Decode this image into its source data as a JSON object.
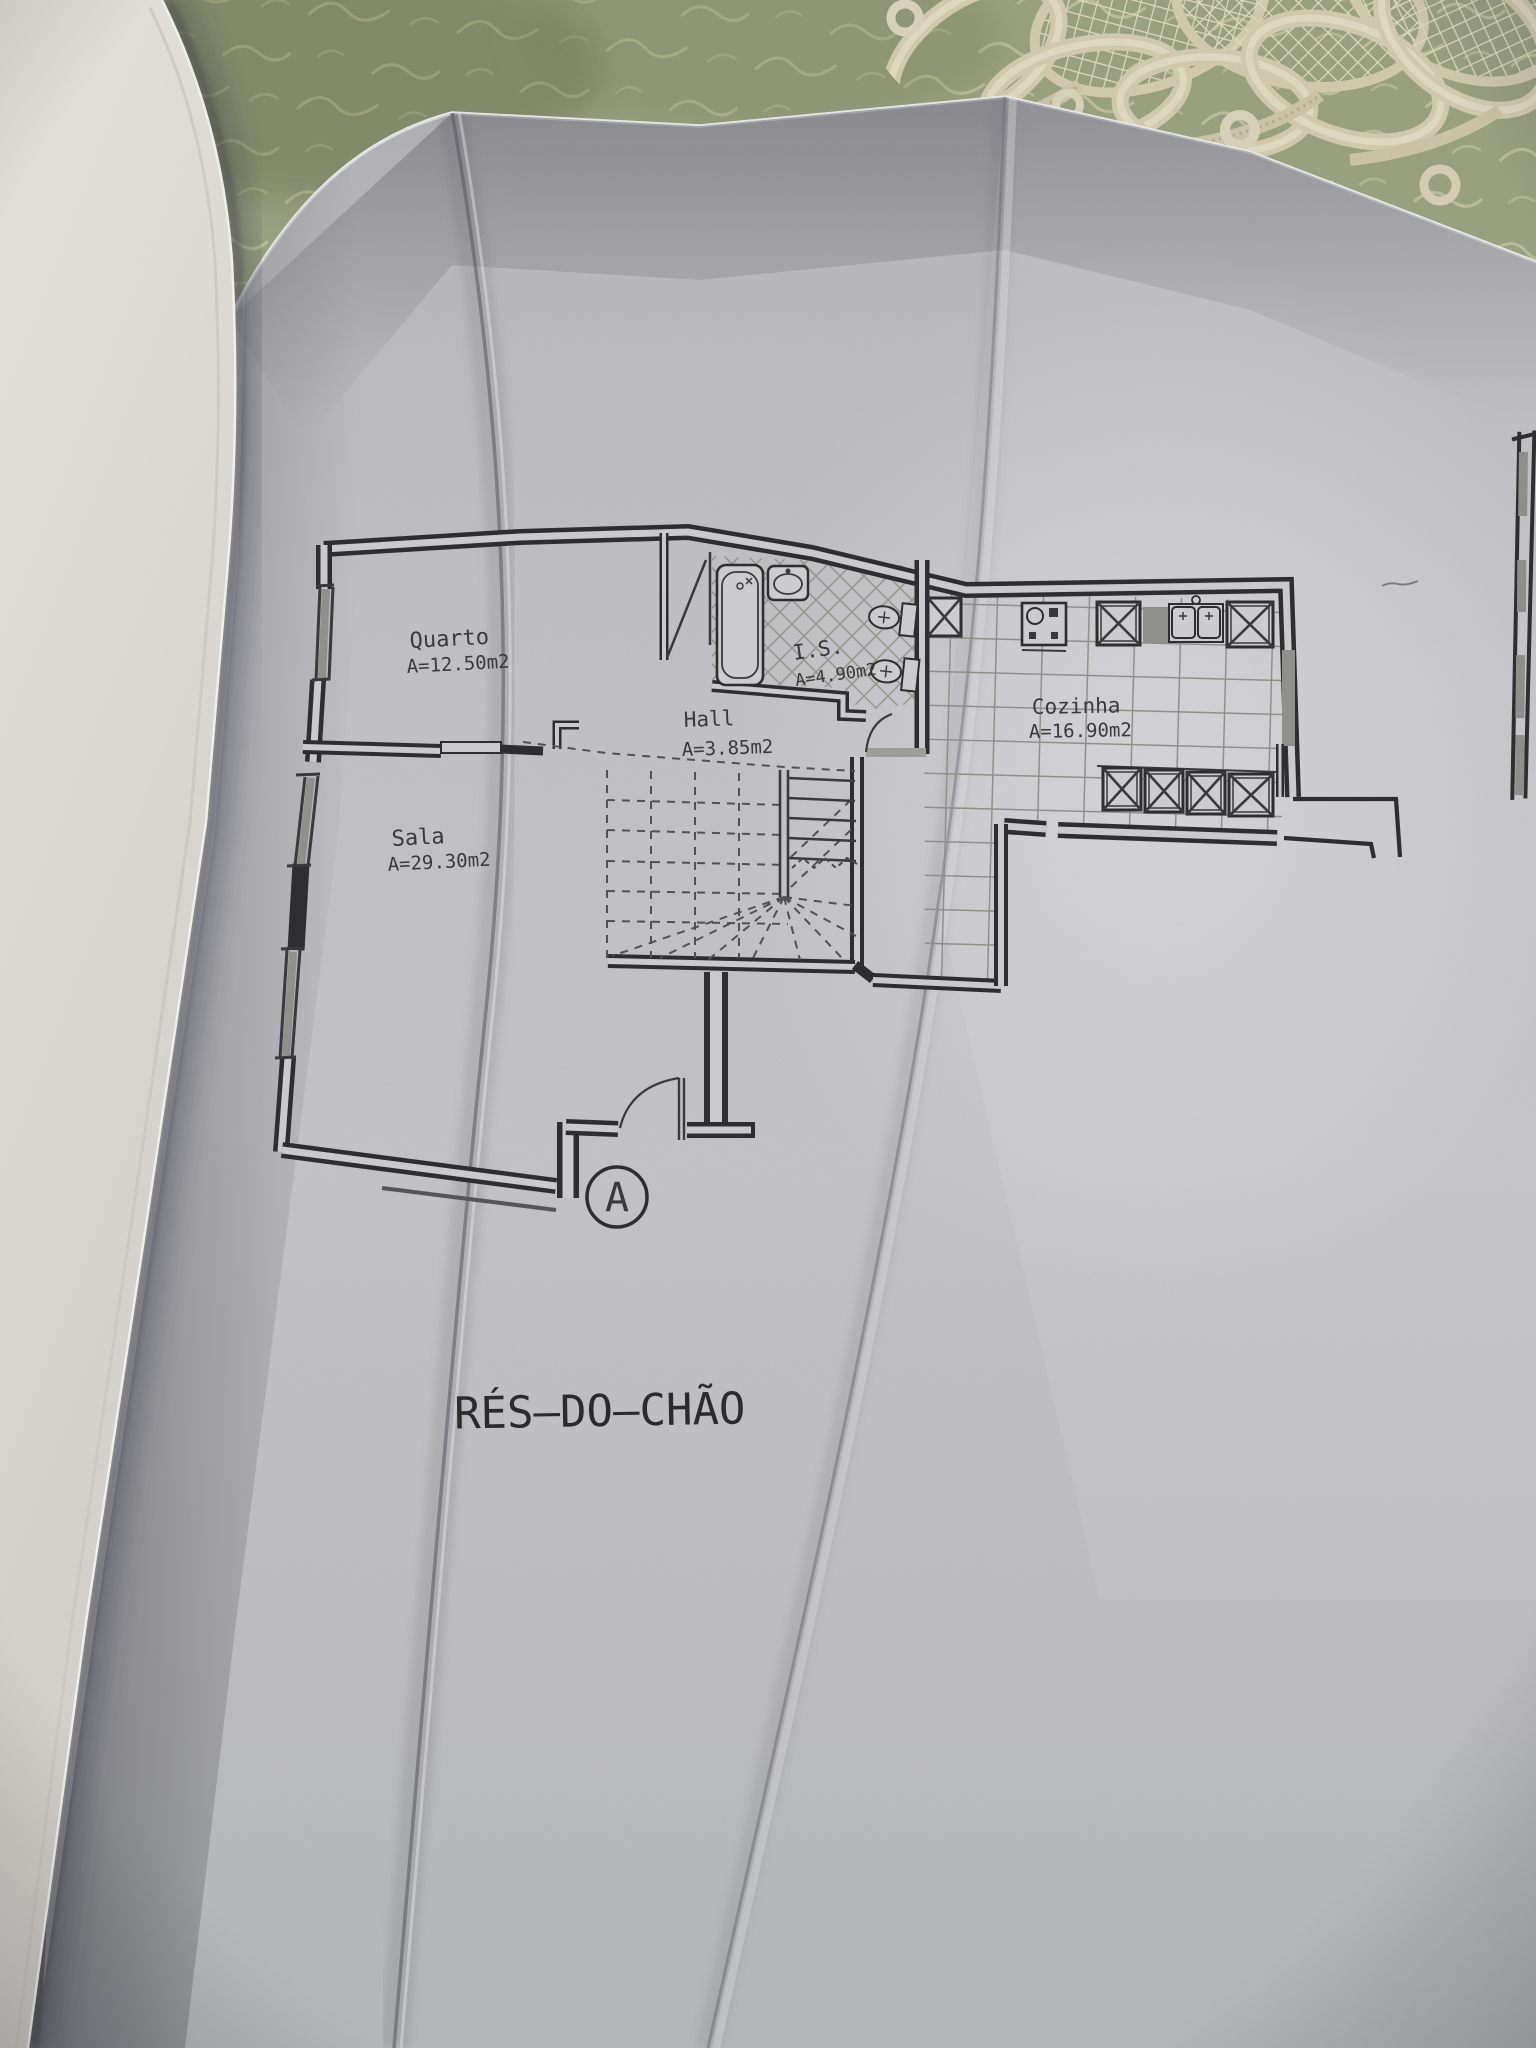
{
  "scene": {
    "description": "Photograph of a ground-floor architectural plan on a folded sheet in an open binder, on a lace-edged tablecloth",
    "colors": {
      "tablecloth": "#99a080",
      "lace": "#d6cfb5",
      "page_paper": "#c8c8cc",
      "binder_cover": "#e0ddd8",
      "ink": "#2d2d2f",
      "pencil_grid": "#8e8e8a",
      "window_fill": "#8f8f8b"
    }
  },
  "floor_plan": {
    "title": "RÉS—DO—CHÃO",
    "section_marker": "A",
    "rooms": [
      {
        "id": "quarto",
        "name": "Quarto",
        "area": "A=12.50m2"
      },
      {
        "id": "sala",
        "name": "Sala",
        "area": "A=29.30m2"
      },
      {
        "id": "hall",
        "name": "Hall",
        "area": "A=3.85m2"
      },
      {
        "id": "is",
        "name": "I.S.",
        "area": "A=4.90m2"
      },
      {
        "id": "cozinha",
        "name": "Cozinha",
        "area": "A=16.90m2"
      }
    ]
  }
}
